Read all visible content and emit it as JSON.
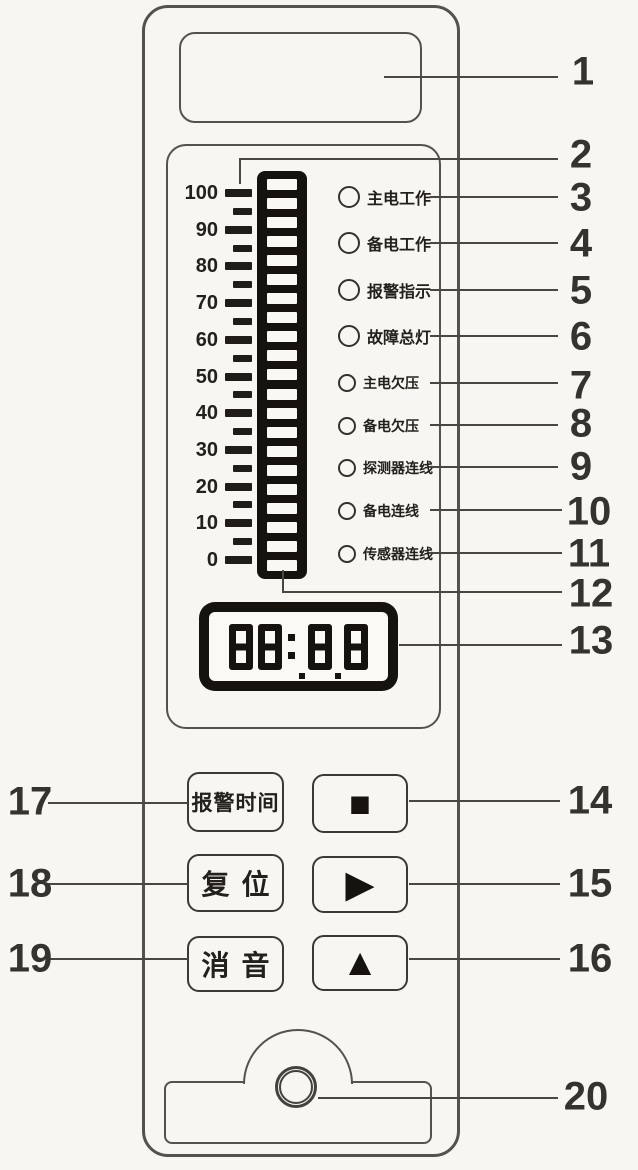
{
  "bargraph": {
    "scale_labels": [
      "100",
      "90",
      "80",
      "70",
      "60",
      "50",
      "40",
      "30",
      "20",
      "10",
      "0"
    ],
    "tick_count": 21,
    "segment_count": 21
  },
  "indicators": [
    {
      "label": "主电工作",
      "size": "lg"
    },
    {
      "label": "备电工作",
      "size": "lg"
    },
    {
      "label": "报警指示",
      "size": "lg"
    },
    {
      "label": "故障总灯",
      "size": "lg"
    },
    {
      "label": "主电欠压",
      "size": "sm"
    },
    {
      "label": "备电欠压",
      "size": "sm"
    },
    {
      "label": "探测器连线",
      "size": "sm"
    },
    {
      "label": "备电连线",
      "size": "sm"
    },
    {
      "label": "传感器连线",
      "size": "sm"
    }
  ],
  "display": {
    "value": "88:88"
  },
  "buttons": {
    "alarm_time": "报警时间",
    "reset": "复位",
    "mute": "消音",
    "stop_symbol": "■",
    "right_symbol": "▶",
    "up_symbol": "▲"
  },
  "callouts": [
    "1",
    "2",
    "3",
    "4",
    "5",
    "6",
    "7",
    "8",
    "9",
    "10",
    "11",
    "12",
    "13",
    "14",
    "15",
    "16",
    "17",
    "18",
    "19",
    "20"
  ],
  "colors": {
    "ink": "#16130f",
    "line": "#55524d",
    "paper": "#f7f6f2"
  }
}
